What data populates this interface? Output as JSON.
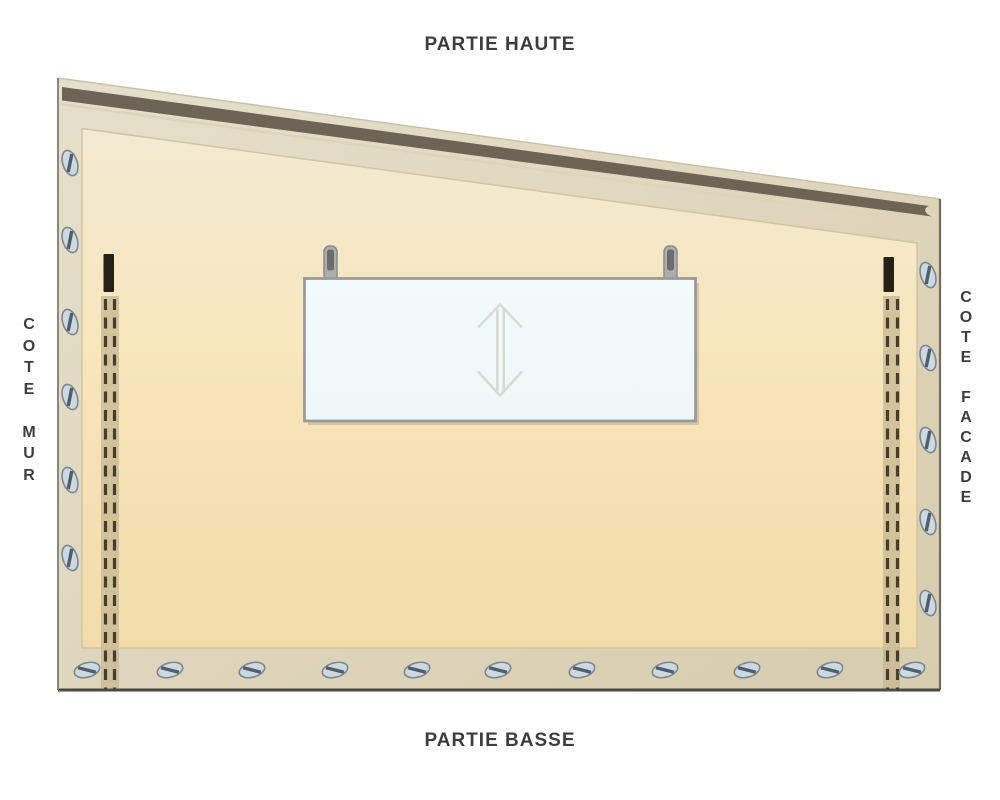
{
  "labels": {
    "top": "PARTIE HAUTE",
    "bottom": "PARTIE BASSE",
    "left": "COTE MUR",
    "right": "COTE FACADE"
  },
  "icons": {
    "screw-icon": "slotted screw head (ellipse with diagonal slot)",
    "vertical-double-arrow-icon": "↕",
    "hanger-clip-icon": "rounded tab with dark slot",
    "zipper-icon": "double dashed line with top stop"
  },
  "palette": {
    "background": "#ffffff",
    "label_text": "#3d3d3d",
    "hem_light": "#e6dfcb",
    "hem_dark": "#d7cdaf",
    "field_top": "#f2ead3",
    "field_mid": "#f8e6bd",
    "field_bottom": "#f2dcaa",
    "bar": "#6d6456",
    "bar_highlight": "#ddd4b9",
    "edge_top": "#c9c1a7",
    "edge_left": "#8a877d",
    "edge_right": "#6e6b62",
    "edge_bottom": "#4c4941",
    "inner_line": "#d2c5a0",
    "zipper_strip": "#c9ba93",
    "zipper_dash": "#453d2e",
    "zipper_stop": "#272015",
    "screw_fill": "#cdd9e1",
    "screw_stroke": "#7e8791",
    "screw_slot": "#505f6b",
    "window_fill": "#edf8f7",
    "window_border": "#9b9b9b",
    "window_shadow": "#b5a98c",
    "clip_fill": "#adadad",
    "clip_border": "#8b8b8b",
    "clip_slot": "#6c6c6c",
    "arrow": "#d6dcd5"
  },
  "diagram": {
    "screws": {
      "left_edge": {
        "x": 70,
        "rotation": 72,
        "y_positions": [
          163,
          240,
          322,
          397,
          480,
          558
        ]
      },
      "right_edge": {
        "x": 928,
        "rotation": 72,
        "y_positions": [
          275,
          358,
          440,
          522,
          603
        ]
      },
      "bottom_edge": {
        "y": 670,
        "rotation": -15,
        "x_positions": [
          87,
          170,
          252,
          335,
          417,
          498,
          582,
          665,
          747,
          830,
          912
        ]
      }
    }
  }
}
